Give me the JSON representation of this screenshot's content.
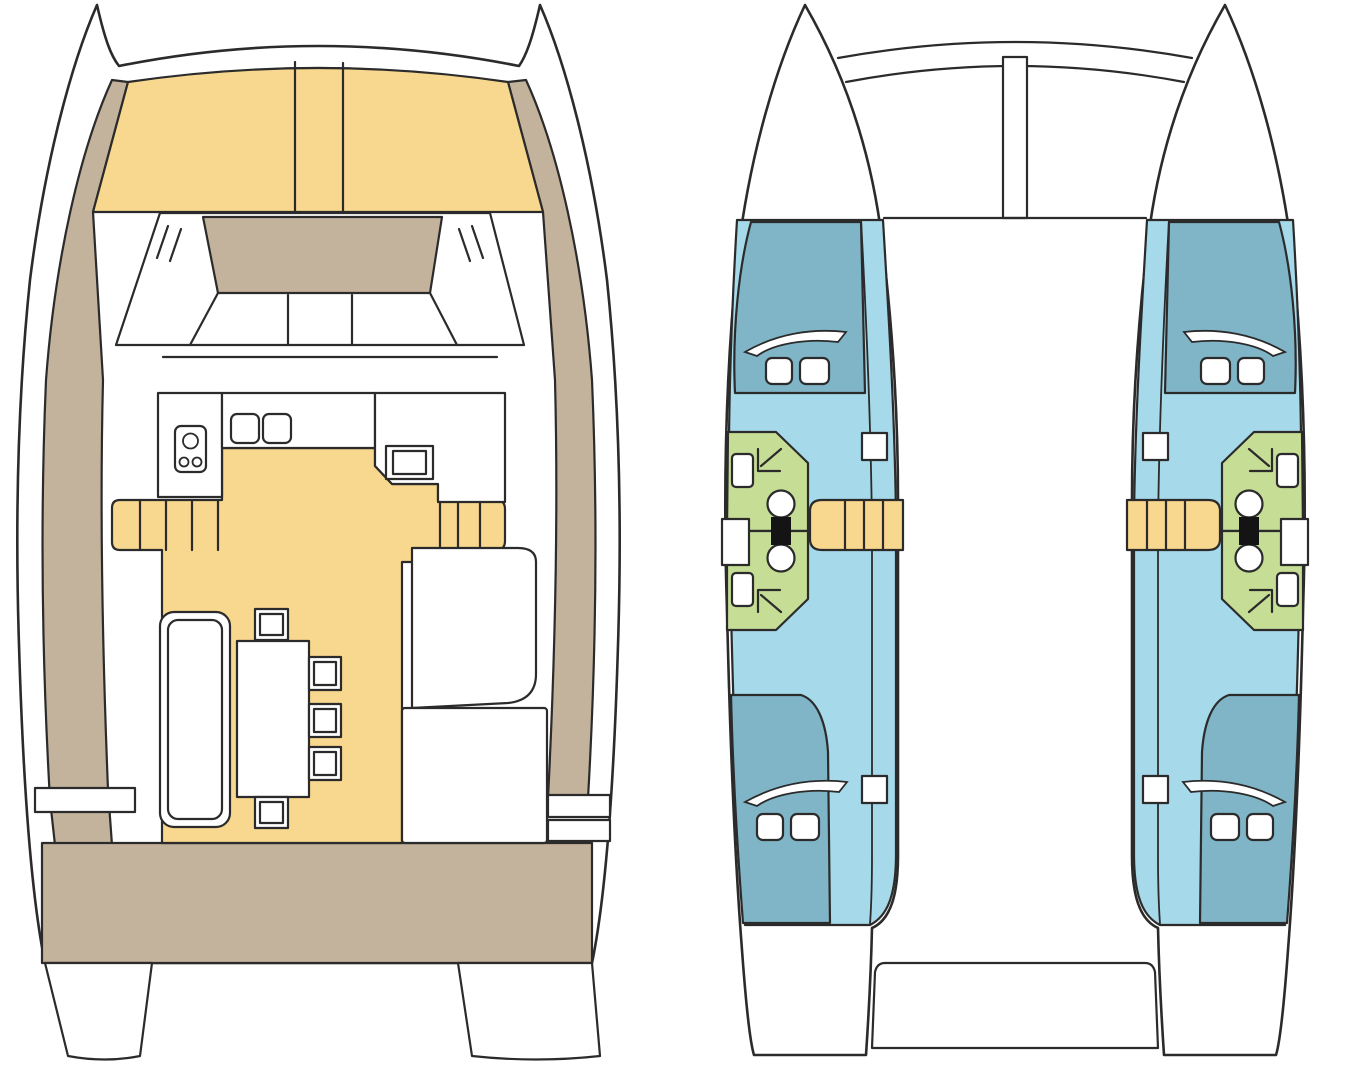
{
  "diagram": {
    "type": "boat-floor-plan",
    "vessel": "sailing-catamaran",
    "views": {
      "deck_plan": {
        "position": "left",
        "areas": [
          {
            "name": "foredeck-sunpads",
            "color": "cushion"
          },
          {
            "name": "side-decks",
            "color": "deck"
          },
          {
            "name": "coachroof",
            "color": "deck"
          },
          {
            "name": "forward-seating-windshield",
            "color": "hull"
          },
          {
            "name": "galley",
            "color": "hull",
            "fixtures": [
              "stove-3-burner",
              "double-sink",
              "sink-unit"
            ]
          },
          {
            "name": "saloon-floor",
            "color": "cushion"
          },
          {
            "name": "dinette",
            "fixtures": [
              "sofa-bench",
              "table",
              "chair",
              "chair",
              "chair",
              "chair",
              "chair"
            ]
          },
          {
            "name": "nav-seats",
            "color": "hull"
          },
          {
            "name": "boarding-steps",
            "color": "cushion"
          },
          {
            "name": "aft-cockpit",
            "color": "deck"
          },
          {
            "name": "transoms",
            "color": "hull"
          }
        ]
      },
      "hull_plan": {
        "position": "right",
        "areas": [
          {
            "name": "forward-cabin-berth",
            "color": "berth",
            "fixtures": [
              "hull-window",
              "hatch",
              "hatch"
            ]
          },
          {
            "name": "cabin-sole",
            "color": "cabin_floor"
          },
          {
            "name": "bathroom-forward",
            "color": "bathroom",
            "fixtures": [
              "sink",
              "shower",
              "toilet"
            ]
          },
          {
            "name": "bathroom-aft",
            "color": "bathroom",
            "fixtures": [
              "sink",
              "shower",
              "toilet"
            ]
          },
          {
            "name": "companionway-steps",
            "color": "cushion"
          },
          {
            "name": "aft-cabin-berth",
            "color": "berth",
            "fixtures": [
              "hull-window",
              "hatch",
              "hatch"
            ]
          },
          {
            "name": "bridgedeck",
            "fixtures": [
              "crossbeam-arcs",
              "mast-support",
              "aft-cockpit-recess"
            ]
          }
        ]
      }
    }
  },
  "colors": {
    "outline": "#2b2b2b",
    "hull": "#ffffff",
    "deck": "#c4b39c",
    "cushion": "#f8d78e",
    "cabin_floor": "#a6d9e9",
    "berth": "#7fb5c7",
    "bathroom": "#c6dd96",
    "fixture_dark": "#141414",
    "background": "#ffffff"
  }
}
